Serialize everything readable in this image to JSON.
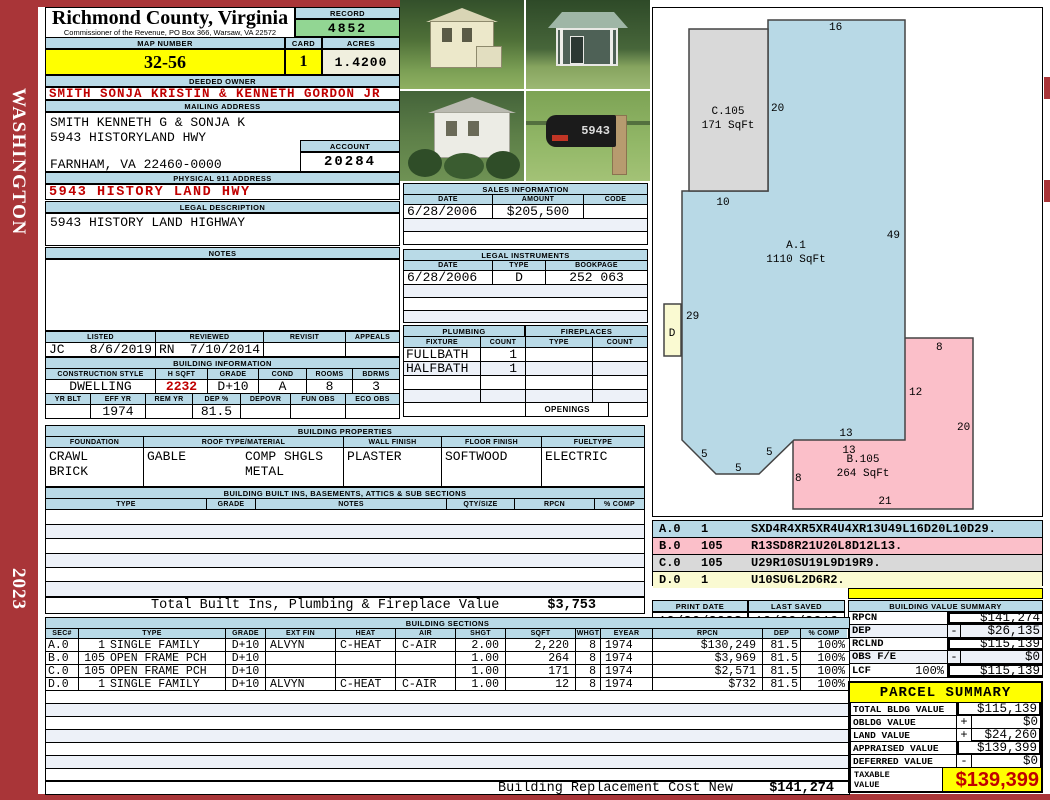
{
  "title": {
    "county": "Richmond County, Virginia",
    "subtitle": "Commissioner of the Revenue, PO Box 366, Warsaw, VA 22572"
  },
  "sidebar": {
    "state": "WASHINGTON",
    "year": "2023"
  },
  "labels": {
    "record": "RECORD",
    "map_number": "MAP NUMBER",
    "card": "CARD",
    "acres": "ACRES",
    "deeded_owner": "DEEDED OWNER",
    "mailing_address": "MAILING ADDRESS",
    "account": "ACCOUNT",
    "physical_911": "PHYSICAL 911 ADDRESS",
    "legal_description": "LEGAL DESCRIPTION",
    "notes": "NOTES",
    "listed": "LISTED",
    "reviewed": "REVIEWED",
    "revisit": "REVISIT",
    "appeals": "APPEALS",
    "building_information": "BUILDING INFORMATION",
    "construction_style": "CONSTRUCTION STYLE",
    "hsqft": "H SQFT",
    "grade": "GRADE",
    "cond": "COND",
    "rooms": "ROOMS",
    "bdrms": "BDRMS",
    "yr_blt": "YR BLT",
    "eff_yr": "EFF YR",
    "rem_yr": "REM YR",
    "dep_pct": "DEP %",
    "depovr": "DEPOVR",
    "fun_obs": "FUN OBS",
    "eco_obs": "ECO OBS",
    "building_properties": "BUILDING PROPERTIES",
    "foundation": "FOUNDATION",
    "roof": "ROOF TYPE/MATERIAL",
    "wall_finish": "WALL FINISH",
    "floor_finish": "FLOOR FINISH",
    "fuel_type": "FUELTYPE",
    "built_ins": "BUILDING BUILT INS, BASEMENTS, ATTICS & SUB SECTIONS",
    "type": "TYPE",
    "notes_col": "NOTES",
    "qty_size": "QTY/SIZE",
    "rpcn": "RPCN",
    "pct_comp": "% COMP",
    "sales_information": "SALES INFORMATION",
    "date": "DATE",
    "amount": "AMOUNT",
    "code": "CODE",
    "legal_instruments": "LEGAL INSTRUMENTS",
    "bookpage": "BOOKPAGE",
    "plumbing": "PLUMBING",
    "fixture": "FIXTURE",
    "count": "COUNT",
    "fireplaces": "FIREPLACES",
    "openings": "OPENINGS",
    "building_sections": "BUILDING SECTIONS",
    "sec": "SEC#",
    "ext_fin": "EXT FIN",
    "heat": "HEAT",
    "air": "AIR",
    "shgt": "SHGT",
    "sqft": "SQFT",
    "whgt": "WHGT",
    "eyear": "EYEAR",
    "dep": "DEP",
    "print_date": "PRINT DATE",
    "last_saved": "LAST SAVED",
    "building_value_summary": "BUILDING VALUE SUMMARY",
    "rclnd": "RCLND",
    "obs_fe": "OBS F/E",
    "lcf": "LCF"
  },
  "summary_top": {
    "record": "4852",
    "map_number": "32-56",
    "card": "1",
    "acres": "1.4200"
  },
  "owner": {
    "deeded": "SMITH SONJA KRISTIN & KENNETH GORDON JR",
    "mailing_line1": "SMITH KENNETH G & SONJA K",
    "mailing_line2": "5943 HISTORYLAND HWY",
    "mailing_line3": "FARNHAM, VA 22460-0000",
    "account": "20284",
    "physical_911": "5943 HISTORY LAND HWY",
    "legal_description": "5943 HISTORY LAND HIGHWAY"
  },
  "review": {
    "listed_by": "JC",
    "listed_date": "8/6/2019",
    "reviewed_by": "RN",
    "reviewed_date": "7/10/2014"
  },
  "building_info": {
    "style": "DWELLING",
    "hsqft": "2232",
    "grade": "D+10",
    "cond": "A",
    "rooms": "8",
    "bdrms": "3",
    "eff_yr": "1974",
    "dep_pct": "81.5"
  },
  "building_properties": {
    "foundation1": "CRAWL",
    "foundation2": "BRICK",
    "roof_type": "GABLE",
    "roof_material1": "COMP SHGLS",
    "roof_material2": "METAL",
    "wall_finish": "PLASTER",
    "floor_finish": "SOFTWOOD",
    "fuel_type": "ELECTRIC"
  },
  "built_ins": {
    "total_label": "Total Built Ins, Plumbing & Fireplace Value",
    "total_value": "$3,753"
  },
  "sales": {
    "date": "6/28/2006",
    "amount": "$205,500",
    "code": ""
  },
  "legal_instruments": {
    "date": "6/28/2006",
    "type": "D",
    "bookpage": "252 063"
  },
  "plumbing": {
    "fixture1": "FULLBATH",
    "count1": "1",
    "fixture2": "HALFBATH",
    "count2": "1"
  },
  "building_sections": {
    "rows": [
      {
        "sec": "A.0",
        "type_num": "1",
        "type": "SINGLE FAMILY",
        "grade": "D+10",
        "ext_fin": "ALVYN",
        "heat": "C-HEAT",
        "air": "C-AIR",
        "shgt": "2.00",
        "sqft": "2,220",
        "whgt": "8",
        "eyear": "1974",
        "rpcn": "$130,249",
        "dep": "81.5",
        "comp": "100%"
      },
      {
        "sec": "B.0",
        "type_num": "105",
        "type": "OPEN FRAME PCH",
        "grade": "D+10",
        "ext_fin": "",
        "heat": "",
        "air": "",
        "shgt": "1.00",
        "sqft": "264",
        "whgt": "8",
        "eyear": "1974",
        "rpcn": "$3,969",
        "dep": "81.5",
        "comp": "100%"
      },
      {
        "sec": "C.0",
        "type_num": "105",
        "type": "OPEN FRAME PCH",
        "grade": "D+10",
        "ext_fin": "",
        "heat": "",
        "air": "",
        "shgt": "1.00",
        "sqft": "171",
        "whgt": "8",
        "eyear": "1974",
        "rpcn": "$2,571",
        "dep": "81.5",
        "comp": "100%"
      },
      {
        "sec": "D.0",
        "type_num": "1",
        "type": "SINGLE FAMILY",
        "grade": "D+10",
        "ext_fin": "ALVYN",
        "heat": "C-HEAT",
        "air": "C-AIR",
        "shgt": "1.00",
        "sqft": "12",
        "whgt": "8",
        "eyear": "1974",
        "rpcn": "$732",
        "dep": "81.5",
        "comp": "100%"
      }
    ],
    "replacement_label": "Building Replacement Cost New",
    "replacement_value": "$141,274"
  },
  "sketch": {
    "area_a_name": "A.1",
    "area_a_sqft": "1110 SqFt",
    "area_b_name": "B.105",
    "area_b_sqft": "264 SqFt",
    "area_c_name": "C.105",
    "area_c_sqft": "171 SqFt",
    "area_d_name": "D",
    "dims": {
      "a_top": "16",
      "c_right": "20",
      "c_bottom": "10",
      "a_right": "49",
      "a_left": "29",
      "a_bottom": "13",
      "chamfer1": "5",
      "chamfer2": "5",
      "chamfer3": "5",
      "b_top": "8",
      "b_right_upper": "12",
      "b_right": "20",
      "b_top_left": "13",
      "b_left": "8",
      "b_bottom": "21"
    },
    "legend": [
      {
        "sec": "A.0",
        "num": "1",
        "vector": "SXD4R4XR5XR4U4XR13U49L16D20L10D29."
      },
      {
        "sec": "B.0",
        "num": "105",
        "vector": "R13SD8R21U20L8D12L13."
      },
      {
        "sec": "C.0",
        "num": "105",
        "vector": "U29R10SU19L9D19R9."
      },
      {
        "sec": "D.0",
        "num": "1",
        "vector": "U10SU6L2D6R2."
      }
    ]
  },
  "dates": {
    "print_date": "10/26/2023",
    "last_saved": "10/30/2019"
  },
  "building_value_summary": {
    "rows": [
      {
        "label": "RPCN",
        "op": "",
        "value": "$141,274"
      },
      {
        "label": "DEP",
        "op": "-",
        "value": "$26,135"
      },
      {
        "label": "RCLND",
        "op": "",
        "value": "$115,139"
      },
      {
        "label": "OBS F/E",
        "op": "-",
        "value": "$0"
      },
      {
        "label": "LCF",
        "pct": "100%",
        "op": "",
        "value": "$115,139"
      }
    ]
  },
  "parcel_summary": {
    "title": "PARCEL SUMMARY",
    "rows": [
      {
        "label": "TOTAL BLDG VALUE",
        "op": "",
        "value": "$115,139"
      },
      {
        "label": "OBLDG VALUE",
        "op": "+",
        "value": "$0"
      },
      {
        "label": "LAND VALUE",
        "op": "+",
        "value": "$24,260"
      },
      {
        "label": "APPRAISED VALUE",
        "op": "",
        "value": "$139,399"
      },
      {
        "label": "DEFERRED VALUE",
        "op": "-",
        "value": "$0"
      }
    ],
    "taxable_label": "TAXABLE VALUE",
    "taxable_value": "$139,399"
  },
  "photos": {
    "mailbox_number": "5943"
  },
  "colors": {
    "header_blue": "#B9DAE7",
    "highlight_yellow": "#FFFF00",
    "record_green": "#92D693",
    "acres_cream": "#F0EFDE",
    "accent_red": "#C00000",
    "sidebar_red": "#A93538",
    "sketch_blue": "#B8D9E6",
    "sketch_pink": "#FBBFC9",
    "sketch_gray": "#D9D9D9",
    "sketch_yellow": "#FAFAD2",
    "row_stripe": "#EDF1F8"
  }
}
